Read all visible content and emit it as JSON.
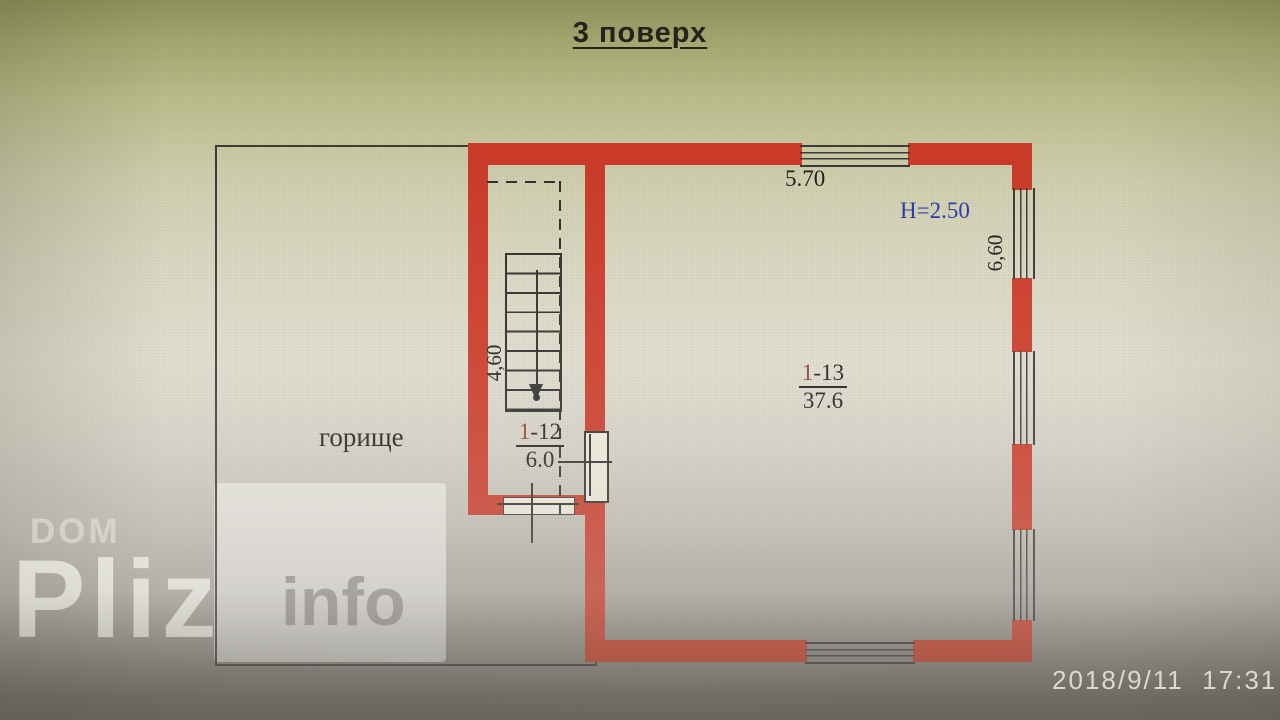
{
  "title": "3 поверх",
  "plan": {
    "attic_label": "горище",
    "height_label": "H=2.50",
    "dim_top": "5.70",
    "dim_right": "6,60",
    "dim_stair": "4,60",
    "room_main": {
      "prefix": "1",
      "rest": "-13",
      "area": "37.6"
    },
    "room_stair": {
      "prefix": "1",
      "rest": "-12",
      "area": "6.0"
    }
  },
  "watermark": {
    "dom": "DOM",
    "pliz": "Pliz",
    "info": "info"
  },
  "timestamp": "2018/9/11  17:31",
  "colors": {
    "wall": "#c93a28",
    "blue": "#2837a6",
    "ink": "#1f1f1f",
    "room_prefix": "#8a4034"
  }
}
